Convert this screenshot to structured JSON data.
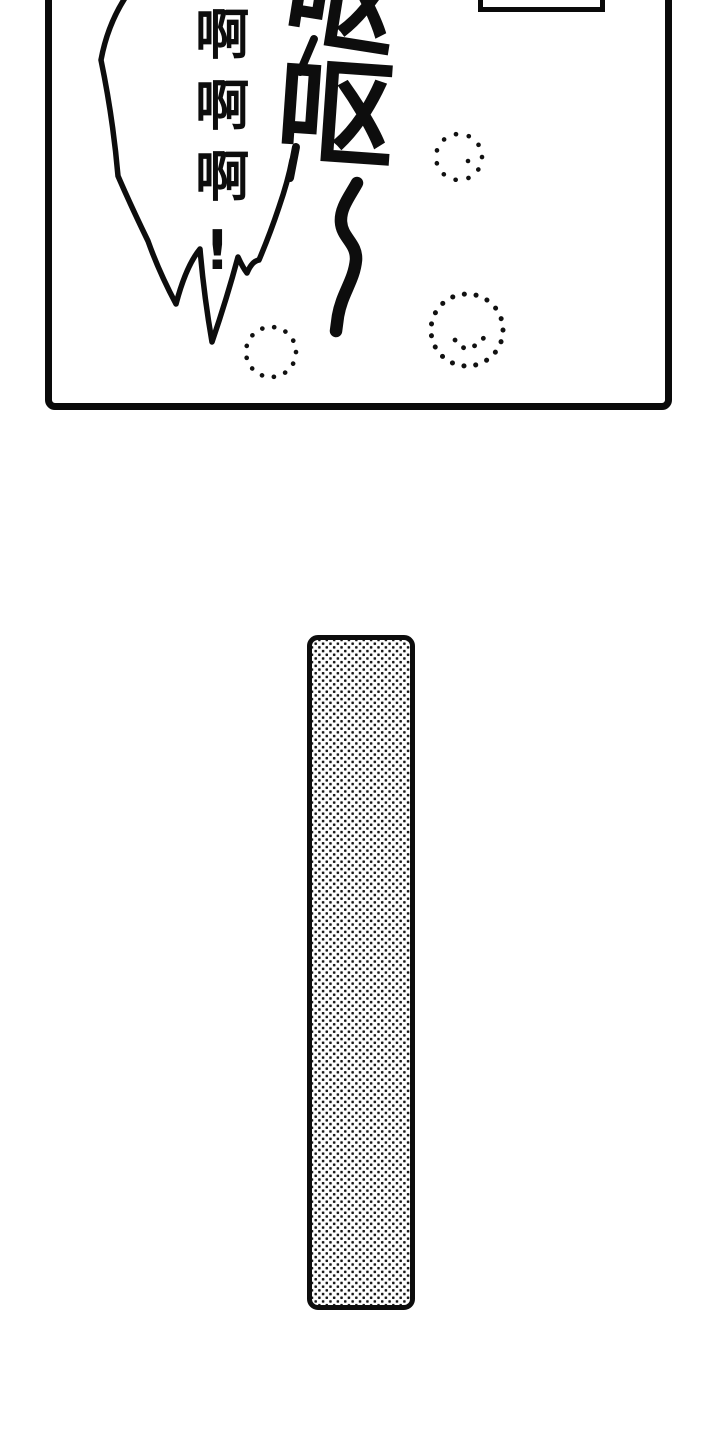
{
  "panel": {
    "scream_text": "啊啊啊!",
    "sfx_vomit_1": "呕",
    "sfx_vomit_2": "呕"
  },
  "colors": {
    "ink": "#0d0d0d",
    "paper": "#ffffff"
  }
}
